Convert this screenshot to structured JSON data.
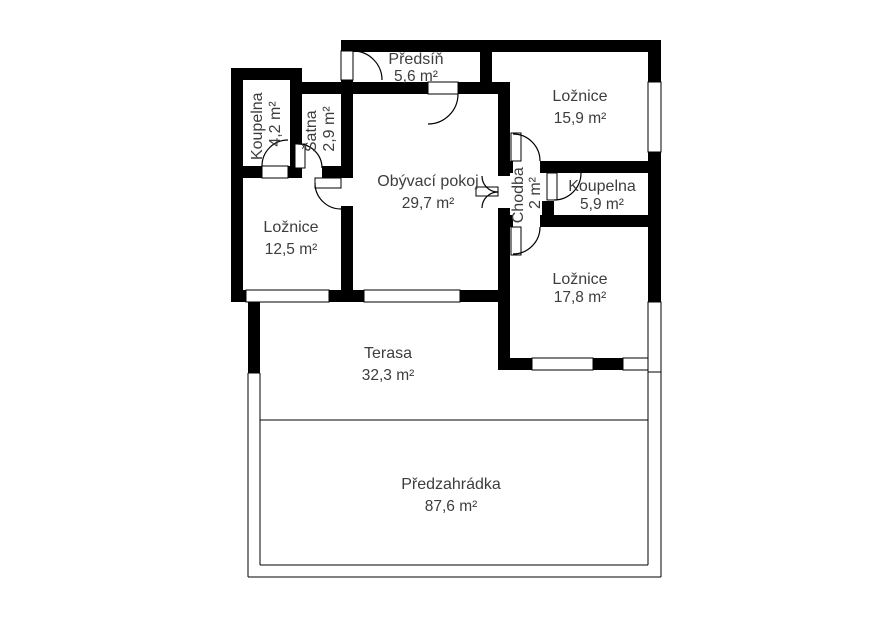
{
  "plan_title": "Floor plan",
  "colors": {
    "wall": "#000000",
    "text": "#3d3d3d",
    "background": "#ffffff"
  },
  "rooms": {
    "predsin": {
      "name": "Předsíň",
      "area": "5,6 m²"
    },
    "loznice_top": {
      "name": "Ložnice",
      "area": "15,9 m²"
    },
    "koupelna_left": {
      "name": "Koupelna",
      "area": "4,2 m²"
    },
    "satna": {
      "name": "Šatna",
      "area": "2,9 m²"
    },
    "obyvaci_pokoj": {
      "name": "Obývací pokoj",
      "area": "29,7 m²"
    },
    "chodba": {
      "name": "Chodba",
      "area": "2 m²"
    },
    "koupelna_right": {
      "name": "Koupelna",
      "area": "5,9 m²"
    },
    "loznice_left": {
      "name": "Ložnice",
      "area": "12,5 m²"
    },
    "loznice_bottom": {
      "name": "Ložnice",
      "area": "17,8 m²"
    },
    "terasa": {
      "name": "Terasa",
      "area": "32,3 m²"
    },
    "predzahradka": {
      "name": "Předzahrádka",
      "area": "87,6 m²"
    }
  }
}
